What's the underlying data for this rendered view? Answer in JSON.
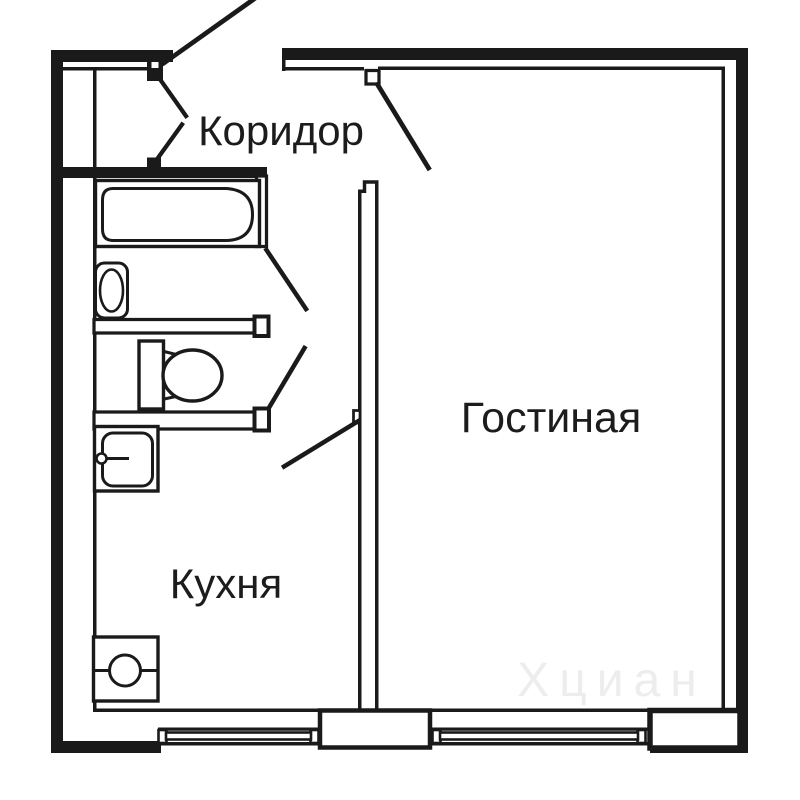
{
  "page": {
    "background": "#ffffff"
  },
  "plan": {
    "line_color": "#1a1a1a",
    "text_color": "#1c1c1c",
    "watermark": {
      "text": "Хциан",
      "color": "#ededed"
    },
    "rooms": {
      "corridor": {
        "label": "Коридор"
      },
      "living": {
        "label": "Гостиная"
      },
      "kitchen": {
        "label": "Кухня"
      }
    },
    "fixtures": [
      "bathtub",
      "washbasin",
      "toilet",
      "kitchen-sink",
      "stove"
    ],
    "windows": 2,
    "doors": [
      "entrance",
      "closet",
      "bathroom",
      "toilet",
      "kitchen",
      "living-room"
    ]
  }
}
